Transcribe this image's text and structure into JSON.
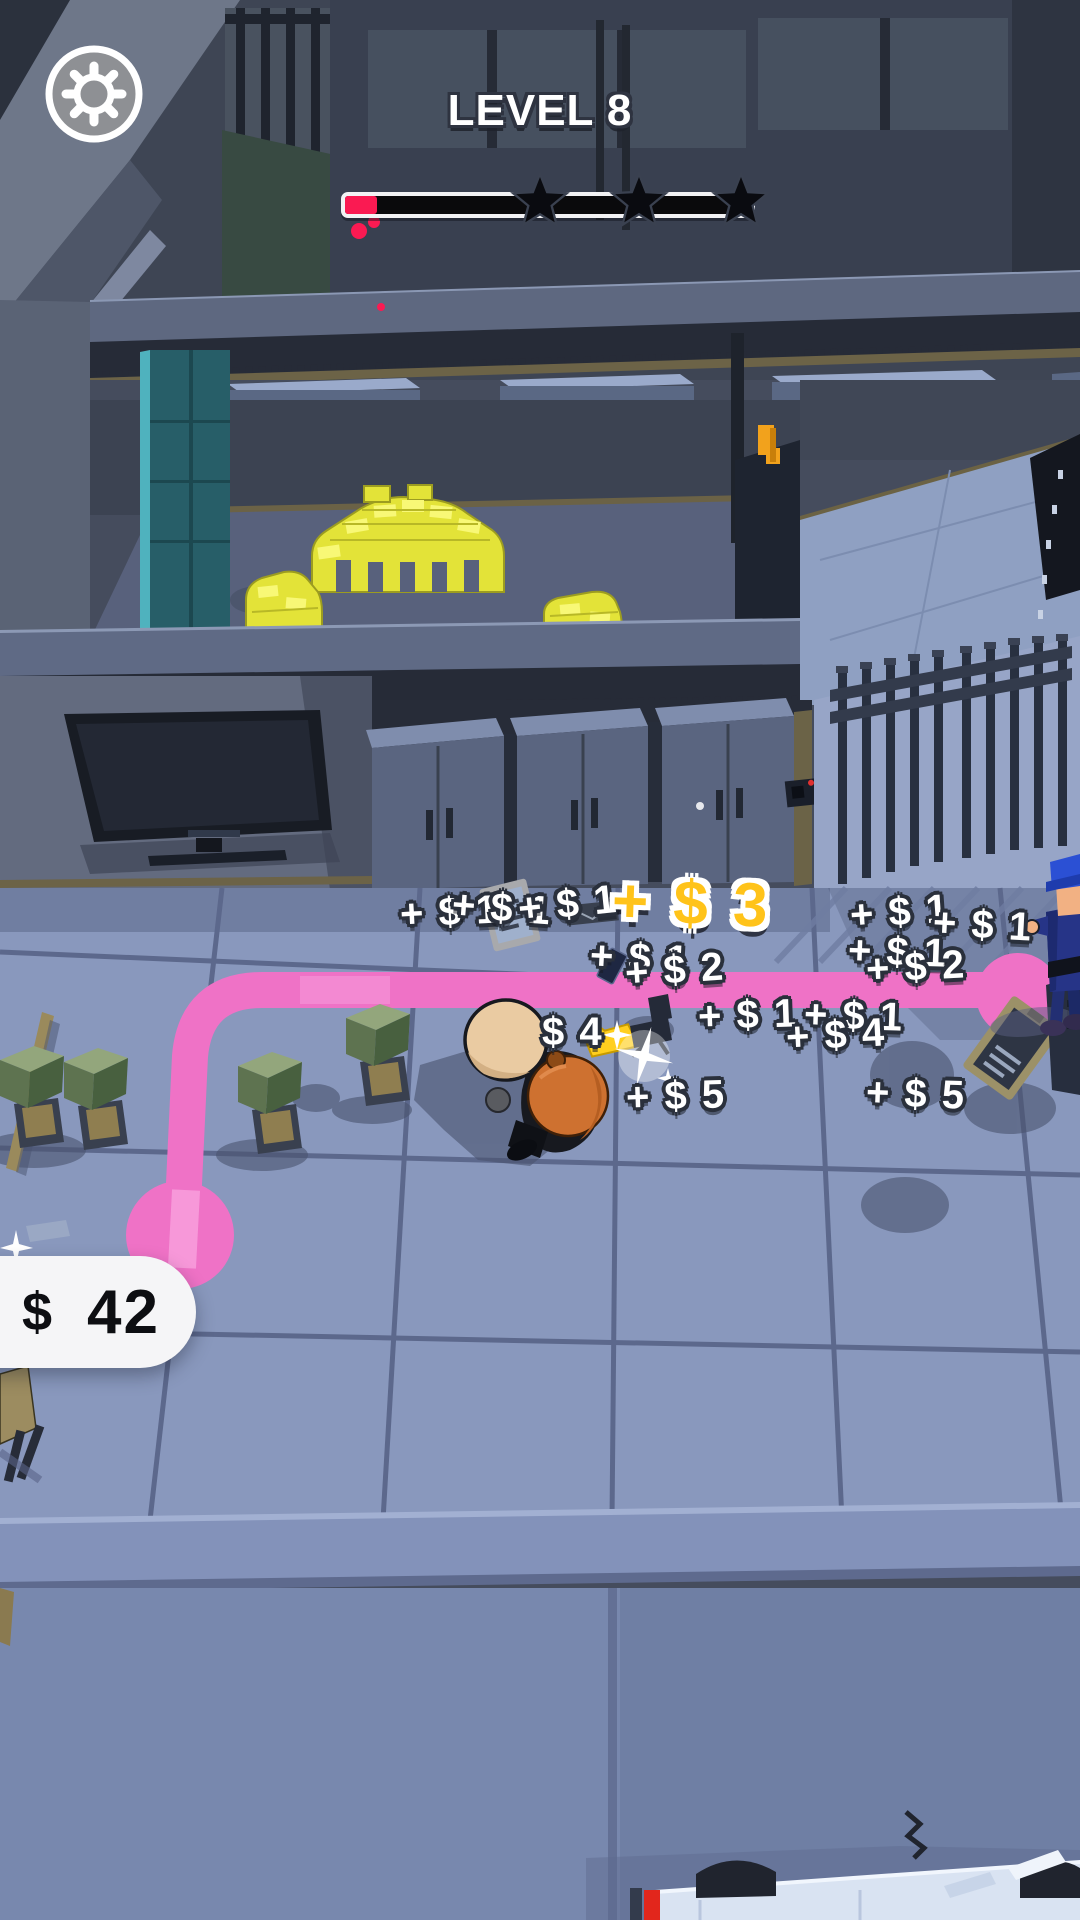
{
  "hud": {
    "level_title": "LEVEL 8",
    "progress_bar": {
      "fill_percent": 8,
      "fill_color": "#FA1A52",
      "stars_total": 3
    },
    "money_counter": {
      "currency_symbol": "$",
      "amount": "42"
    }
  },
  "popups": [
    {
      "text": "+ $ 1"
    },
    {
      "text": "+ $ 1"
    },
    {
      "text": "+ $ 1"
    },
    {
      "text": "+ $ 1"
    },
    {
      "text": "+ $ 2"
    },
    {
      "text": "+ $ 1"
    },
    {
      "text": "+ $ 1"
    },
    {
      "text": "+ $ 1"
    },
    {
      "text": "+ $ 2"
    },
    {
      "text": "+ $ 1"
    },
    {
      "text": "+ $ 1"
    },
    {
      "text": "+ $ 4"
    },
    {
      "text": "$ 4"
    },
    {
      "text": "+ $ 5"
    },
    {
      "text": "+ $ 5"
    }
  ],
  "big_popup": {
    "text": "+ $ 3",
    "color": "#FFC31A"
  },
  "colors": {
    "path_pink": "#EF72C6",
    "path_pink_light": "#F9A6DF",
    "gold": "#E3E338",
    "progress_red": "#FA1A52",
    "popup_yellow": "#FFC31A",
    "floor": "#8998BD",
    "officer_blue": "#2B50D4",
    "thief_sack_orange": "#CE7130"
  },
  "icons": {
    "settings": "gear-icon"
  }
}
